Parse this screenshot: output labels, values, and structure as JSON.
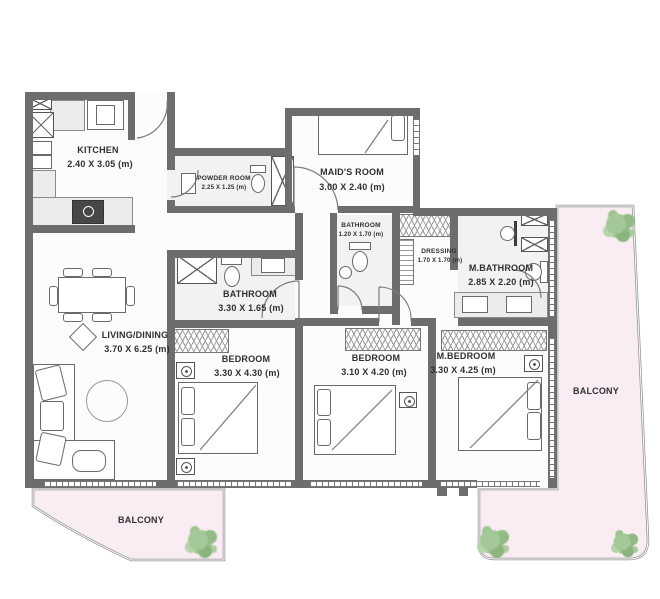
{
  "rooms": {
    "kitchen": {
      "name": "KITCHEN",
      "dims": "2.40 X 3.05 (m)"
    },
    "powder_room": {
      "name": "POWDER ROOM",
      "dims": "2.25 X 1.25 (m)"
    },
    "maids_room": {
      "name": "MAID'S ROOM",
      "dims": "3.00 X 2.40 (m)"
    },
    "bathroom_small": {
      "name": "BATHROOM",
      "dims": "1.20 X 1.70 (m)"
    },
    "dressing": {
      "name": "DRESSING",
      "dims": "1.70 X 1.70 (m)"
    },
    "master_bathroom": {
      "name": "M.BATHROOM",
      "dims": "2.85 X 2.20 (m)"
    },
    "bathroom": {
      "name": "BATHROOM",
      "dims": "3.30 X 1.65 (m)"
    },
    "living_dining": {
      "name": "LIVING/DINING",
      "dims": "3.70 X 6.25 (m)"
    },
    "bedroom_1": {
      "name": "BEDROOM",
      "dims": "3.30 X 4.30 (m)"
    },
    "bedroom_2": {
      "name": "BEDROOM",
      "dims": "3.10 X 4.20 (m)"
    },
    "master_bedroom": {
      "name": "M.BEDROOM",
      "dims": "3.30 X 4.25 (m)"
    },
    "balcony_right": {
      "name": "BALCONY"
    },
    "balcony_bottom": {
      "name": "BALCONY"
    }
  },
  "symbols": {
    "shaft": "crossed-box",
    "wardrobe": "zigzag-hatch",
    "plant": "shrub",
    "window": "dashed-band",
    "door": "quarter-arc"
  },
  "colors": {
    "wall": "#6d6d6d",
    "balcony_fill": "#f9ecf2",
    "plant": "#9ec695",
    "floor": "#fcfcfc",
    "line": "#777777",
    "text": "#2f2f2f"
  }
}
